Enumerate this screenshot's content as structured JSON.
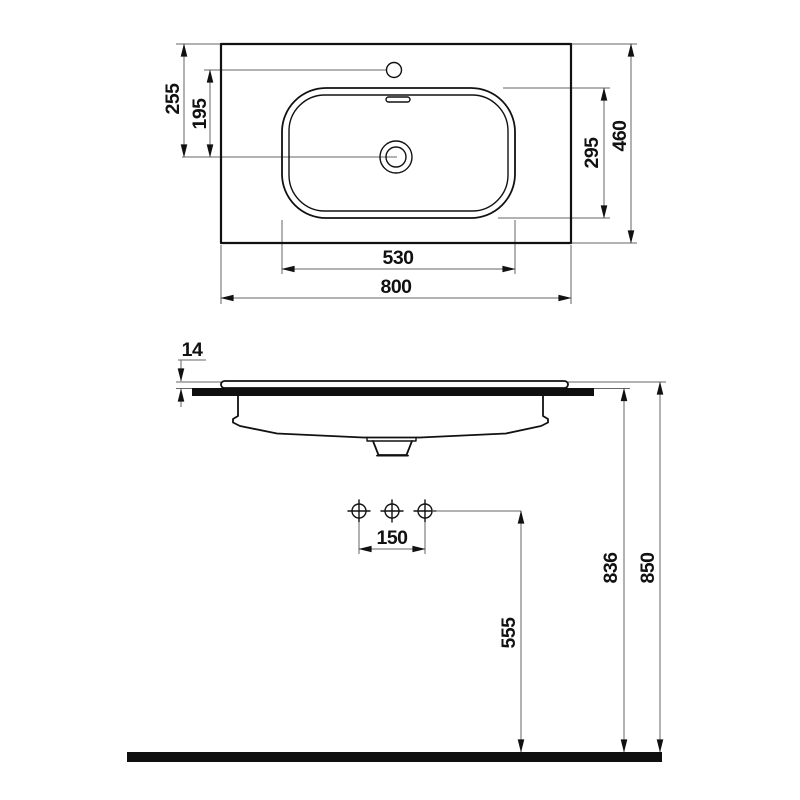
{
  "top_view": {
    "overall_width": "800",
    "overall_depth": "460",
    "basin_width": "530",
    "basin_depth": "295",
    "rear_edge_to_drain": "255",
    "tap_hole_to_drain": "195"
  },
  "front_view": {
    "rim_above_counter": "14",
    "tap_hole_spacing": "150",
    "hole_height_from_floor": "555",
    "counter_top_height": "836",
    "rim_top_height": "850"
  },
  "colors": {
    "object_line": "#111111",
    "dimension_line": "#666666",
    "background": "#ffffff"
  }
}
